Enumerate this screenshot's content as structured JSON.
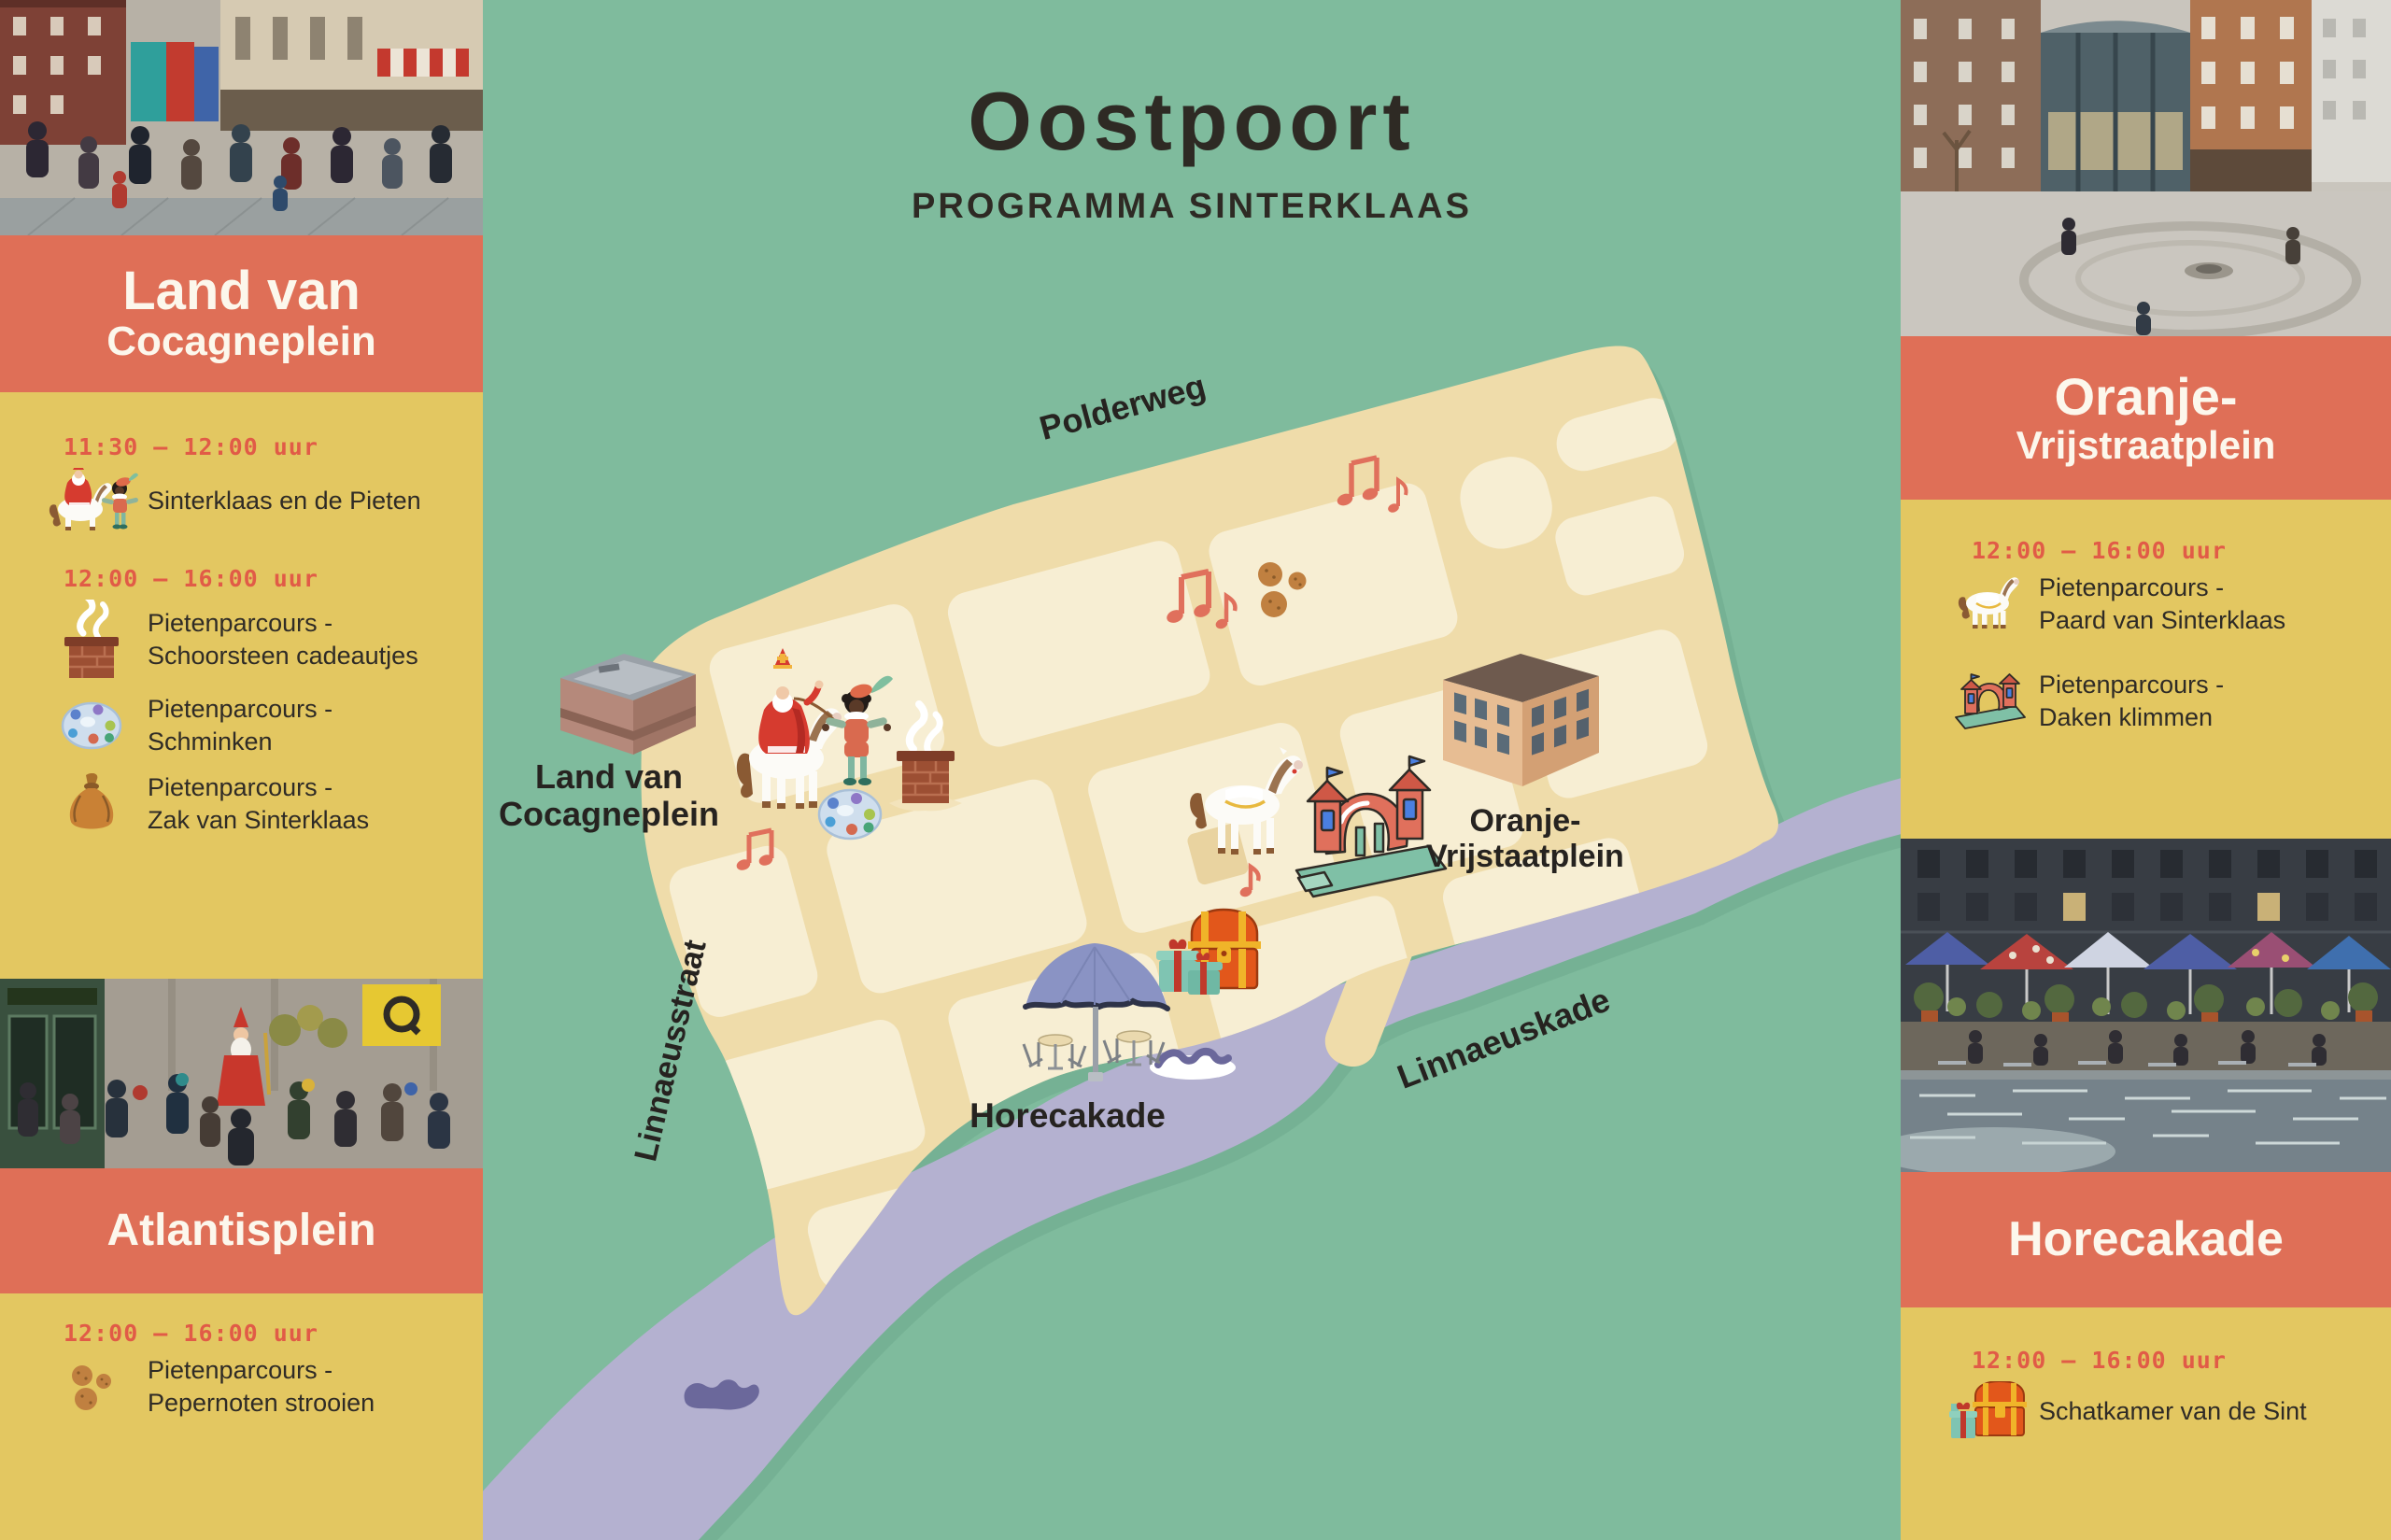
{
  "title": {
    "main": "Oostpoort",
    "subtitle": "PROGRAMMA SINTERKLAAS"
  },
  "colors": {
    "background_green": "#7fbb9d",
    "panel_orange": "#df6f57",
    "panel_yellow": "#e3c761",
    "time_red": "#e15b47",
    "dark_text": "#2f2b26",
    "header_white": "#fcf7ec",
    "map_tan": "#efdcaa",
    "map_block": "#f7eed3",
    "river_lavender": "#b4b1d0"
  },
  "left_panel": {
    "header1": {
      "line1": "Land van",
      "line2": "Cocagneplein"
    },
    "s1_time1": "11:30 – 12:00 uur",
    "s1_item1": {
      "icon": "sinterklaas-and-piet",
      "l1": "Sinterklaas en de Pieten"
    },
    "s1_time2": "12:00 – 16:00 uur",
    "s1_item2": {
      "icon": "chimney",
      "l1": "Pietenparcours -",
      "l2": "Schoorsteen cadeautjes"
    },
    "s1_item3": {
      "icon": "paint-palette",
      "l1": "Pietenparcours - Schminken"
    },
    "s1_item4": {
      "icon": "gift-sack",
      "l1": "Pietenparcours -",
      "l2": "Zak van Sinterklaas"
    },
    "header2": "Atlantisplein",
    "s2_time1": "12:00 – 16:00 uur",
    "s2_item1": {
      "icon": "pepernoten",
      "l1": "Pietenparcours -",
      "l2": "Pepernoten strooien"
    }
  },
  "right_panel": {
    "header1": {
      "line1": "Oranje-",
      "line2": "Vrijstraatplein"
    },
    "s1_time1": "12:00 – 16:00 uur",
    "s1_item1": {
      "icon": "horse",
      "l1": "Pietenparcours -",
      "l2": "Paard van Sinterklaas"
    },
    "s1_item2": {
      "icon": "bouncy-castle",
      "l1": "Pietenparcours -",
      "l2": "Daken klimmen"
    },
    "header2": "Horecakade",
    "s2_time1": "12:00 – 16:00 uur",
    "s2_item1": {
      "icon": "treasure-chest",
      "l1": "Schatkamer van de Sint"
    }
  },
  "map": {
    "streets": {
      "polderweg": "Polderweg",
      "linnaeusstraat": "Linnaeusstraat",
      "linnaeuskade": "Linnaeuskade"
    },
    "areas": {
      "cocagne_l1": "Land van",
      "cocagne_l2": "Cocagneplein",
      "oranje_l1": "Oranje-",
      "oranje_l2": "Vrijstaatplein",
      "horecakade": "Horecakade"
    },
    "illustrations": [
      "landmark-building",
      "sinterklaas-on-horse",
      "piet",
      "chimney",
      "paint-palette",
      "music-notes",
      "pepernoten",
      "white-horse",
      "bouncy-castle",
      "apartment-building",
      "treasure-chest",
      "gift-boxes",
      "parasol-terrace",
      "water-wave"
    ]
  }
}
